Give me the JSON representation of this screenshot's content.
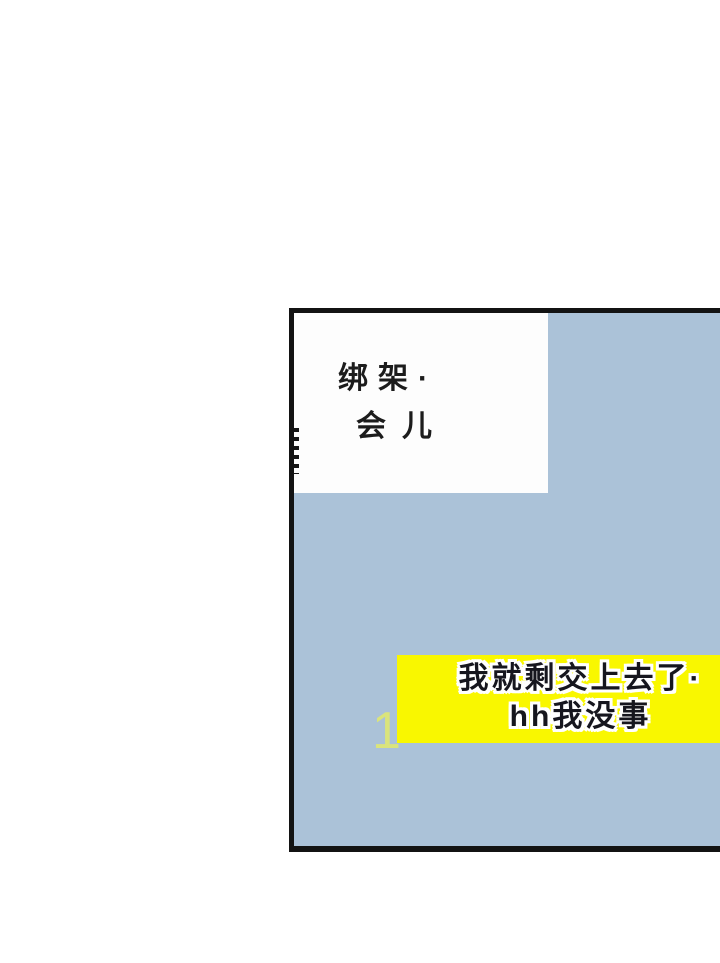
{
  "page": {
    "background_color": "#ffffff",
    "description": "comic-panel"
  },
  "panel": {
    "background_color": "#abc2d8",
    "border_color": "#131313",
    "speech_bubble": {
      "background_color": "#fdfdfd",
      "text_color": "#1c1c1c",
      "lines": [
        "绑架·",
        "会儿"
      ]
    },
    "caption_banner": {
      "background_color": "#f9f700",
      "text_color": "#16161e",
      "outline_color": "#ffffff",
      "lines": [
        "我就剩交上去了·",
        "hh我没事"
      ]
    },
    "watermark": {
      "text": "1",
      "color": "#dde678"
    }
  }
}
